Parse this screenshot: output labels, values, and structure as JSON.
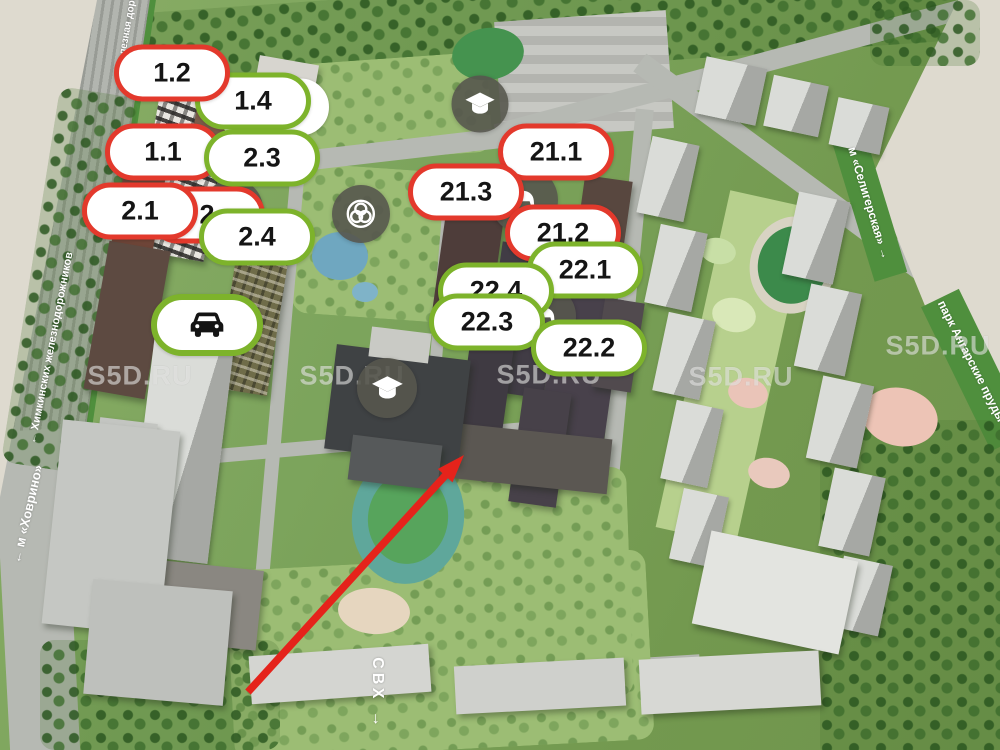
{
  "map_title": "masterplan-3d-view",
  "watermark": {
    "text": "S5D.RU",
    "positions": [
      {
        "x": 140,
        "y": 376
      },
      {
        "x": 352,
        "y": 376
      },
      {
        "x": 549,
        "y": 375
      },
      {
        "x": 741,
        "y": 377
      },
      {
        "x": 938,
        "y": 346
      }
    ]
  },
  "street_labels": [
    {
      "name": "railway-top",
      "text": "железная дорога",
      "x": 128,
      "y": 26,
      "rot": -80,
      "size": 10
    },
    {
      "name": "railway",
      "text": "← Химкинских железнодорожников",
      "x": 51,
      "y": 348,
      "rot": -79,
      "size": 11
    },
    {
      "name": "metro-khovrino",
      "text": "← м «Ховрино»",
      "x": 27,
      "y": 514,
      "rot": -77,
      "size": 13
    },
    {
      "name": "metro-seligerskaya",
      "text": "м «Селигерская» →",
      "x": 869,
      "y": 203,
      "rot": 73,
      "size": 12
    },
    {
      "name": "park-angarskie-prudy",
      "text": "парк Ангарские пруды →",
      "x": 975,
      "y": 368,
      "rot": 63,
      "size": 12
    },
    {
      "name": "svh",
      "text": "СВХ →",
      "x": 377,
      "y": 694,
      "rot": 90,
      "size": 16
    }
  ],
  "building_markers": [
    {
      "label": "",
      "variant": "ghost",
      "x": 271,
      "y": 107
    },
    {
      "label": "1.4",
      "variant": "green",
      "x": 253,
      "y": 101
    },
    {
      "label": "1.2",
      "variant": "red",
      "x": 172,
      "y": 73
    },
    {
      "label": "1.1",
      "variant": "red",
      "x": 163,
      "y": 152
    },
    {
      "label": "2.3",
      "variant": "green",
      "x": 262,
      "y": 158
    },
    {
      "label": "2",
      "variant": "red",
      "x": 207,
      "y": 215
    },
    {
      "label": "2.1",
      "variant": "red",
      "x": 140,
      "y": 211
    },
    {
      "label": "2.4",
      "variant": "green",
      "x": 257,
      "y": 237
    },
    {
      "label": "21.1",
      "variant": "red",
      "x": 556,
      "y": 152
    },
    {
      "label": "21.3",
      "variant": "red",
      "x": 466,
      "y": 192
    },
    {
      "label": "21.2",
      "variant": "red",
      "x": 563,
      "y": 233
    },
    {
      "label": "22.1",
      "variant": "green",
      "x": 585,
      "y": 270
    },
    {
      "label": "22.4",
      "variant": "green",
      "x": 496,
      "y": 291
    },
    {
      "label": "22.3",
      "variant": "green",
      "x": 487,
      "y": 322
    },
    {
      "label": "22.2",
      "variant": "green",
      "x": 589,
      "y": 348
    }
  ],
  "amenity_badges": [
    {
      "type": "school",
      "icon": "graduation-cap",
      "x": 480,
      "y": 104,
      "d": 57
    },
    {
      "type": "kindergarten",
      "icon": "rocking-horse",
      "x": 233,
      "y": 209,
      "d": 60
    },
    {
      "type": "brand",
      "icon": "rose-logo",
      "x": 361,
      "y": 214,
      "d": 58
    },
    {
      "type": "kindergarten",
      "icon": "rocking-horse",
      "x": 524,
      "y": 200,
      "d": 68
    },
    {
      "type": "kindergarten",
      "icon": "rocking-horse",
      "x": 545,
      "y": 316,
      "d": 62
    },
    {
      "type": "school",
      "icon": "graduation-cap",
      "x": 387,
      "y": 388,
      "d": 60
    }
  ],
  "parking_marker": {
    "icon": "car",
    "x": 207,
    "y": 325
  },
  "arrow": {
    "from": {
      "x": 248,
      "y": 692
    },
    "to": {
      "x": 464,
      "y": 455
    }
  },
  "colors": {
    "marker_red": "#e3392c",
    "marker_green": "#7db32b",
    "marker_bg": "#ffffff",
    "amenity_circle": "rgba(86,86,78,0.9)",
    "arrow_red": "#e5231b",
    "canvas_beige": "#dedacf",
    "map_green": "#7ca45c",
    "road_gray": "#b6b9b3"
  }
}
